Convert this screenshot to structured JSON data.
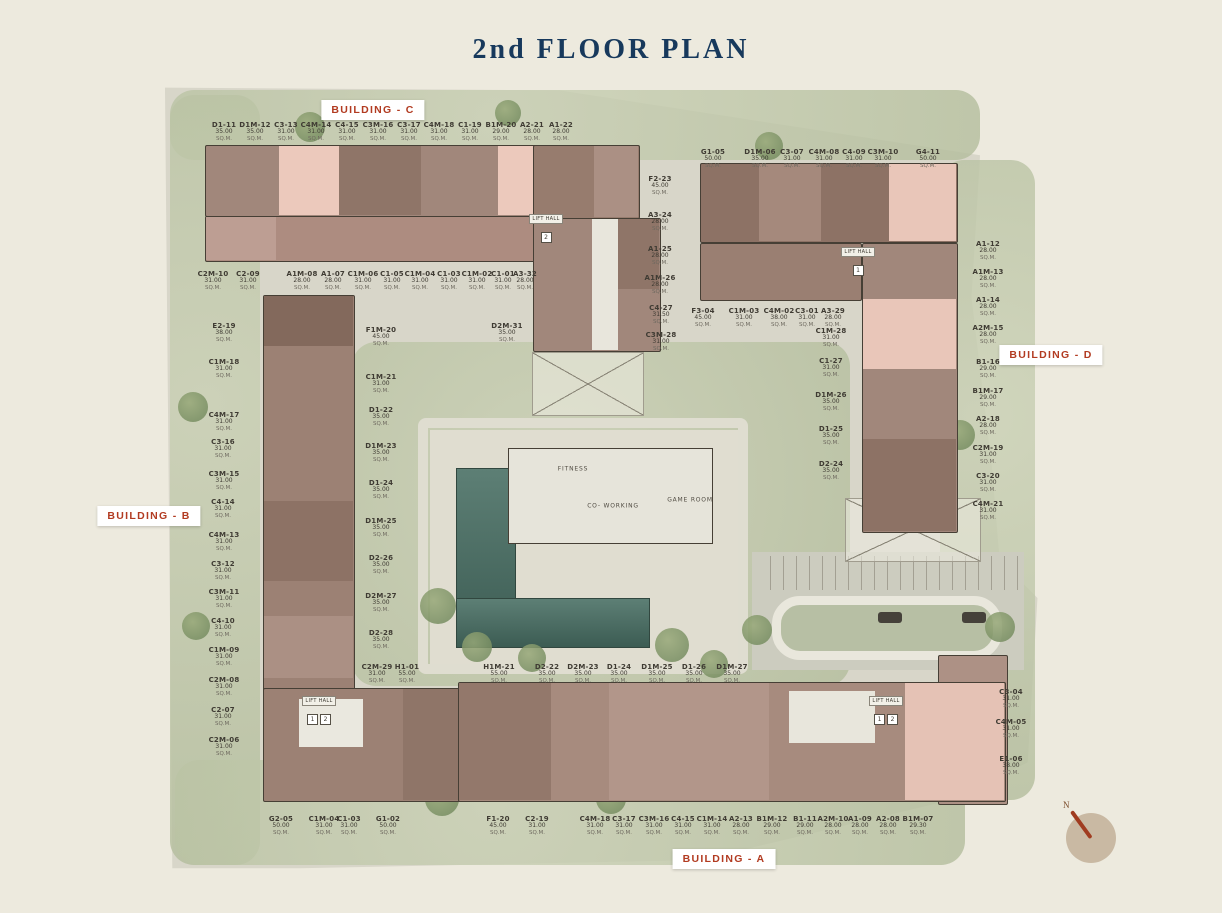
{
  "title": "2nd FLOOR PLAN",
  "sqm_label": "SQ.M.",
  "lift_hall_label": "LIFT HALL",
  "colors": {
    "accent_red": "#b23b21",
    "title_navy": "#17395c"
  },
  "building_tags": [
    {
      "label": "BUILDING - C",
      "x": 373,
      "y": 110
    },
    {
      "label": "BUILDING - D",
      "x": 1051,
      "y": 355
    },
    {
      "label": "BUILDING - B",
      "x": 149,
      "y": 516
    },
    {
      "label": "BUILDING - A",
      "x": 724,
      "y": 859
    }
  ],
  "unit_groups": [
    {
      "name": "building-c-top-row",
      "units": [
        {
          "n": "D1-11",
          "s": "35.00",
          "x": 224,
          "y": 121
        },
        {
          "n": "D1M-12",
          "s": "35.00",
          "x": 255,
          "y": 121
        },
        {
          "n": "C3-13",
          "s": "31.00",
          "x": 286,
          "y": 121
        },
        {
          "n": "C4M-14",
          "s": "31.00",
          "x": 316,
          "y": 121
        },
        {
          "n": "C4-15",
          "s": "31.00",
          "x": 347,
          "y": 121
        },
        {
          "n": "C3M-16",
          "s": "31.00",
          "x": 378,
          "y": 121
        },
        {
          "n": "C3-17",
          "s": "31.00",
          "x": 409,
          "y": 121
        },
        {
          "n": "C4M-18",
          "s": "31.00",
          "x": 439,
          "y": 121
        },
        {
          "n": "C1-19",
          "s": "31.00",
          "x": 470,
          "y": 121
        },
        {
          "n": "B1M-20",
          "s": "29.00",
          "x": 501,
          "y": 121
        },
        {
          "n": "A2-21",
          "s": "28.00",
          "x": 532,
          "y": 121
        },
        {
          "n": "A1-22",
          "s": "28.00",
          "x": 561,
          "y": 121
        }
      ]
    },
    {
      "name": "building-d-top-row",
      "units": [
        {
          "n": "G1-05",
          "s": "50.00",
          "x": 713,
          "y": 148
        },
        {
          "n": "D1M-06",
          "s": "35.00",
          "x": 760,
          "y": 148
        },
        {
          "n": "C3-07",
          "s": "31.00",
          "x": 792,
          "y": 148
        },
        {
          "n": "C4M-08",
          "s": "31.00",
          "x": 824,
          "y": 148
        },
        {
          "n": "C4-09",
          "s": "31.00",
          "x": 854,
          "y": 148
        },
        {
          "n": "C3M-10",
          "s": "31.00",
          "x": 883,
          "y": 148
        },
        {
          "n": "G4-11",
          "s": "50.00",
          "x": 928,
          "y": 148
        }
      ]
    },
    {
      "name": "center-column",
      "units": [
        {
          "n": "F2-23",
          "s": "45.00",
          "x": 660,
          "y": 175
        },
        {
          "n": "A3-24",
          "s": "28.00",
          "x": 660,
          "y": 211
        },
        {
          "n": "A1-25",
          "s": "28.00",
          "x": 660,
          "y": 245
        },
        {
          "n": "A1M-26",
          "s": "28.00",
          "x": 660,
          "y": 274
        },
        {
          "n": "C4-27",
          "s": "31.50",
          "x": 661,
          "y": 304
        },
        {
          "n": "C3M-28",
          "s": "31.00",
          "x": 661,
          "y": 331
        }
      ]
    },
    {
      "name": "building-d-right-column",
      "units": [
        {
          "n": "A1-12",
          "s": "28.00",
          "x": 988,
          "y": 240
        },
        {
          "n": "A1M-13",
          "s": "28.00",
          "x": 988,
          "y": 268
        },
        {
          "n": "A1-14",
          "s": "28.00",
          "x": 988,
          "y": 296
        },
        {
          "n": "A2M-15",
          "s": "28.00",
          "x": 988,
          "y": 324
        },
        {
          "n": "B1-16",
          "s": "29.00",
          "x": 988,
          "y": 358
        },
        {
          "n": "B1M-17",
          "s": "29.00",
          "x": 988,
          "y": 387
        },
        {
          "n": "A2-18",
          "s": "28.00",
          "x": 988,
          "y": 415
        },
        {
          "n": "C2M-19",
          "s": "31.00",
          "x": 988,
          "y": 444
        },
        {
          "n": "C3-20",
          "s": "31.00",
          "x": 988,
          "y": 472
        },
        {
          "n": "C4M-21",
          "s": "31.00",
          "x": 988,
          "y": 500
        }
      ]
    },
    {
      "name": "building-d-inner-row",
      "units": [
        {
          "n": "F3-04",
          "s": "45.00",
          "x": 703,
          "y": 307
        },
        {
          "n": "C1M-03",
          "s": "31.00",
          "x": 744,
          "y": 307
        },
        {
          "n": "C4M-02",
          "s": "38.00",
          "x": 779,
          "y": 307
        },
        {
          "n": "C3-01",
          "s": "31.00",
          "x": 807,
          "y": 307
        },
        {
          "n": "A3-29",
          "s": "28.00",
          "x": 833,
          "y": 307
        }
      ]
    },
    {
      "name": "building-d-inner-column",
      "units": [
        {
          "n": "C1M-28",
          "s": "31.00",
          "x": 831,
          "y": 327
        },
        {
          "n": "C1-27",
          "s": "31.00",
          "x": 831,
          "y": 357
        },
        {
          "n": "D1M-26",
          "s": "35.00",
          "x": 831,
          "y": 391
        },
        {
          "n": "D1-25",
          "s": "35.00",
          "x": 831,
          "y": 425
        },
        {
          "n": "D2-24",
          "s": "35.00",
          "x": 831,
          "y": 460
        }
      ]
    },
    {
      "name": "building-c-bottom-row",
      "units": [
        {
          "n": "C2M-10",
          "s": "31.00",
          "x": 213,
          "y": 270
        },
        {
          "n": "C2-09",
          "s": "31.00",
          "x": 248,
          "y": 270
        },
        {
          "n": "A1M-08",
          "s": "28.00",
          "x": 302,
          "y": 270
        },
        {
          "n": "A1-07",
          "s": "28.00",
          "x": 333,
          "y": 270
        },
        {
          "n": "C1M-06",
          "s": "31.00",
          "x": 363,
          "y": 270
        },
        {
          "n": "C1-05",
          "s": "31.00",
          "x": 392,
          "y": 270
        },
        {
          "n": "C1M-04",
          "s": "31.00",
          "x": 420,
          "y": 270
        },
        {
          "n": "C1-03",
          "s": "31.00",
          "x": 449,
          "y": 270
        },
        {
          "n": "C1M-02",
          "s": "31.00",
          "x": 477,
          "y": 270
        },
        {
          "n": "C1-01",
          "s": "31.00",
          "x": 503,
          "y": 270
        },
        {
          "n": "A3-32",
          "s": "28.00",
          "x": 525,
          "y": 270
        }
      ]
    },
    {
      "name": "building-b-left-column",
      "units": [
        {
          "n": "E2-19",
          "s": "38.00",
          "x": 224,
          "y": 322
        },
        {
          "n": "C1M-18",
          "s": "31.00",
          "x": 224,
          "y": 358
        },
        {
          "n": "C4M-17",
          "s": "31.00",
          "x": 224,
          "y": 411
        },
        {
          "n": "C3-16",
          "s": "31.00",
          "x": 223,
          "y": 438
        },
        {
          "n": "C3M-15",
          "s": "31.00",
          "x": 224,
          "y": 470
        },
        {
          "n": "C4-14",
          "s": "31.00",
          "x": 223,
          "y": 498
        },
        {
          "n": "C4M-13",
          "s": "31.00",
          "x": 224,
          "y": 531
        },
        {
          "n": "C3-12",
          "s": "31.00",
          "x": 223,
          "y": 560
        },
        {
          "n": "C3M-11",
          "s": "31.00",
          "x": 224,
          "y": 588
        },
        {
          "n": "C4-10",
          "s": "31.00",
          "x": 223,
          "y": 617
        },
        {
          "n": "C1M-09",
          "s": "31.00",
          "x": 224,
          "y": 646
        },
        {
          "n": "C2M-08",
          "s": "31.00",
          "x": 224,
          "y": 676
        },
        {
          "n": "C2-07",
          "s": "31.00",
          "x": 223,
          "y": 706
        },
        {
          "n": "C2M-06",
          "s": "31.00",
          "x": 224,
          "y": 736
        }
      ]
    },
    {
      "name": "building-b-inner-column",
      "units": [
        {
          "n": "F1M-20",
          "s": "45.00",
          "x": 381,
          "y": 326
        },
        {
          "n": "C1M-21",
          "s": "31.00",
          "x": 381,
          "y": 373
        },
        {
          "n": "D1-22",
          "s": "35.00",
          "x": 381,
          "y": 406
        },
        {
          "n": "D1M-23",
          "s": "35.00",
          "x": 381,
          "y": 442
        },
        {
          "n": "D1-24",
          "s": "35.00",
          "x": 381,
          "y": 479
        },
        {
          "n": "D1M-25",
          "s": "35.00",
          "x": 381,
          "y": 517
        },
        {
          "n": "D2-26",
          "s": "35.00",
          "x": 381,
          "y": 554
        },
        {
          "n": "D2M-27",
          "s": "35.00",
          "x": 381,
          "y": 592
        },
        {
          "n": "D2-28",
          "s": "35.00",
          "x": 381,
          "y": 629
        }
      ]
    },
    {
      "name": "center-units",
      "units": [
        {
          "n": "D2M-31",
          "s": "35.00",
          "x": 507,
          "y": 322
        }
      ]
    },
    {
      "name": "building-a-row",
      "units": [
        {
          "n": "C2M-29",
          "s": "31.00",
          "x": 377,
          "y": 663
        },
        {
          "n": "H1-01",
          "s": "55.00",
          "x": 407,
          "y": 663
        },
        {
          "n": "H1M-21",
          "s": "55.00",
          "x": 499,
          "y": 663
        },
        {
          "n": "D2-22",
          "s": "35.00",
          "x": 547,
          "y": 663
        },
        {
          "n": "D2M-23",
          "s": "35.00",
          "x": 583,
          "y": 663
        },
        {
          "n": "D1-24",
          "s": "35.00",
          "x": 619,
          "y": 663
        },
        {
          "n": "D1M-25",
          "s": "35.00",
          "x": 657,
          "y": 663
        },
        {
          "n": "D1-26",
          "s": "35.00",
          "x": 694,
          "y": 663
        },
        {
          "n": "D1M-27",
          "s": "35.00",
          "x": 732,
          "y": 663
        }
      ]
    },
    {
      "name": "building-a-right-column",
      "units": [
        {
          "n": "C3-04",
          "s": "31.00",
          "x": 1011,
          "y": 688
        },
        {
          "n": "C4M-05",
          "s": "31.00",
          "x": 1011,
          "y": 718
        },
        {
          "n": "E1-06",
          "s": "38.00",
          "x": 1011,
          "y": 755
        }
      ]
    },
    {
      "name": "building-a-bottom-row",
      "units": [
        {
          "n": "G2-05",
          "s": "50.00",
          "x": 281,
          "y": 815
        },
        {
          "n": "C1M-04",
          "s": "31.00",
          "x": 324,
          "y": 815
        },
        {
          "n": "C1-03",
          "s": "31.00",
          "x": 349,
          "y": 815
        },
        {
          "n": "G1-02",
          "s": "50.00",
          "x": 388,
          "y": 815
        },
        {
          "n": "F1-20",
          "s": "45.00",
          "x": 498,
          "y": 815
        },
        {
          "n": "C2-19",
          "s": "31.00",
          "x": 537,
          "y": 815
        },
        {
          "n": "C4M-18",
          "s": "31.00",
          "x": 595,
          "y": 815
        },
        {
          "n": "C3-17",
          "s": "31.00",
          "x": 624,
          "y": 815
        },
        {
          "n": "C3M-16",
          "s": "31.00",
          "x": 654,
          "y": 815
        },
        {
          "n": "C4-15",
          "s": "31.00",
          "x": 683,
          "y": 815
        },
        {
          "n": "C1M-14",
          "s": "31.00",
          "x": 712,
          "y": 815
        },
        {
          "n": "A2-13",
          "s": "28.00",
          "x": 741,
          "y": 815
        },
        {
          "n": "B1M-12",
          "s": "29.00",
          "x": 772,
          "y": 815
        },
        {
          "n": "B1-11",
          "s": "29.00",
          "x": 805,
          "y": 815
        },
        {
          "n": "A2M-10",
          "s": "28.00",
          "x": 833,
          "y": 815
        },
        {
          "n": "A1-09",
          "s": "28.00",
          "x": 860,
          "y": 815
        },
        {
          "n": "A2-08",
          "s": "28.00",
          "x": 888,
          "y": 815
        },
        {
          "n": "B1M-07",
          "s": "29.30",
          "x": 918,
          "y": 815
        }
      ]
    }
  ],
  "amenities": [
    {
      "label": "FITNESS",
      "x": 573,
      "y": 469
    },
    {
      "label": "CO- WORKING",
      "x": 613,
      "y": 506
    },
    {
      "label": "GAME ROOM",
      "x": 690,
      "y": 500
    }
  ],
  "lift_halls": [
    {
      "x": 546,
      "y": 224,
      "chips": [
        "2"
      ]
    },
    {
      "x": 858,
      "y": 257,
      "chips": [
        "1"
      ]
    },
    {
      "x": 319,
      "y": 706,
      "chips": [
        "1",
        "2"
      ]
    },
    {
      "x": 886,
      "y": 706,
      "chips": [
        "1",
        "2"
      ]
    }
  ],
  "compass": {
    "label": "N"
  }
}
